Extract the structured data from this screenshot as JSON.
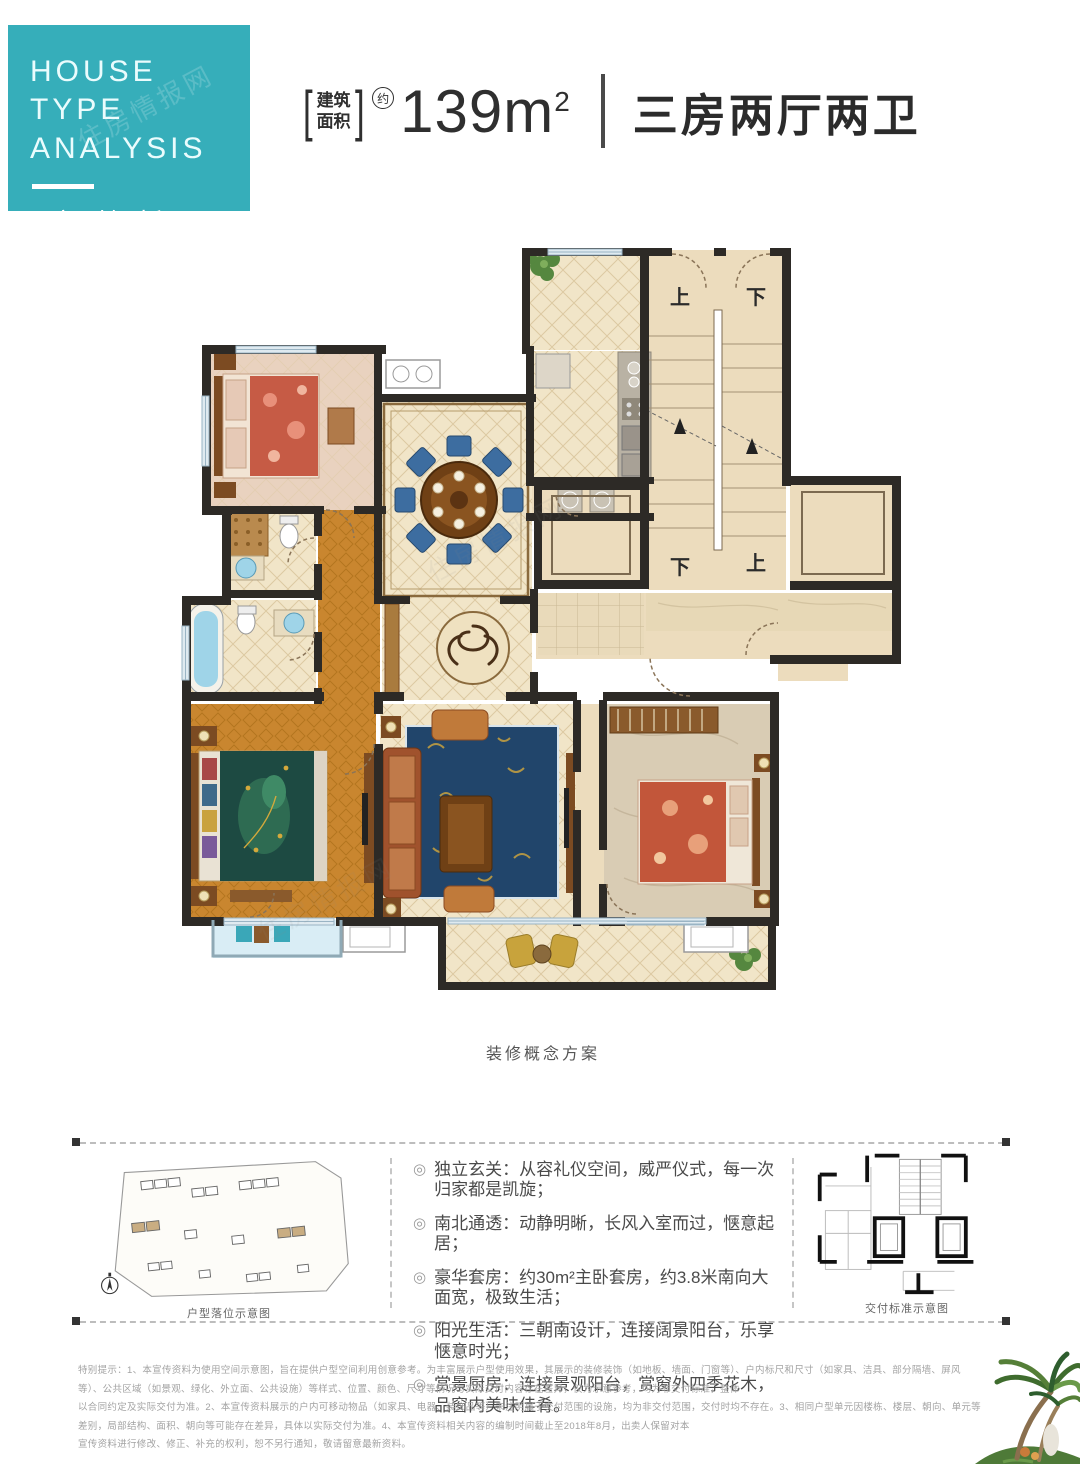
{
  "banner": {
    "title_line1": "HOUSE TYPE",
    "title_line2": "ANALYSIS",
    "subtitle": "E户型解析"
  },
  "header": {
    "area_bracket_top": "建筑",
    "area_bracket_bottom": "面积",
    "approx_badge": "约",
    "area_number": "139m",
    "area_superscript": "2",
    "rooms_text": "三房两厅两卫"
  },
  "floorplan": {
    "caption": "装修概念方案",
    "stair_labels": [
      "上",
      "下",
      "下",
      "上"
    ],
    "watermark": "住房情报网"
  },
  "features": {
    "bullet_icon": "◎",
    "items": [
      "独立玄关：从容礼仪空间，威严仪式，每一次归家都是凯旋；",
      "南北通透：动静明晰，长风入室而过，惬意起居；",
      "豪华套房：约30m²主卧套房，约3.8米南向大面宽，极致生活；",
      "阳光生活：三朝南设计，连接阔景阳台，乐享惬意时光；",
      "赏景厨房：连接景观阳台，赏窗外四季花木，品窗内美味佳肴。"
    ],
    "left_caption": "户型落位示意图",
    "right_caption": "交付标准示意图"
  },
  "disclaimer": {
    "lines": [
      "特别提示：1、本宣传资料为使用空间示意图，旨在提供户型空间利用创意参考。为丰富展示户型使用效果，其展示的装修装饰（如地板、墙面、门窗等）、户内标尺和尺寸（如家具、洁具、部分隔墙、屏风等）、公共区域（如景观、绿化、外立面、公共设施）等样式、位置、颜色、尺寸等情况与实际交付内容存在差异，仅为示意参考，均为非交付标准，整体",
      "以合同约定及实际交付为准。2、本宣传资料展示的户内可移动物品（如家具、电器、装饰品等）未注明属于交付范围的设施，均为非交付范围，交付时均不存在。3、相同户型单元因楼栋、楼层、朝向、单元等差别，局部结构、面积、朝向等可能存在差异，具体以实际交付为准。4、本宣传资料相关内容的编制时间截止至2018年8月，出卖人保留对本",
      "宣传资料进行修改、修正、补充的权利，恕不另行通知，敬请留意最新资料。"
    ]
  },
  "colors": {
    "teal": "#36aeba",
    "wall": "#2d2a26",
    "floor_cream": "#f1e5c8",
    "floor_beige": "#ecdcbd",
    "hall_orange": "#c9862f",
    "rug_blue": "#21456b",
    "fixture_blue": "#9fd4e8"
  }
}
